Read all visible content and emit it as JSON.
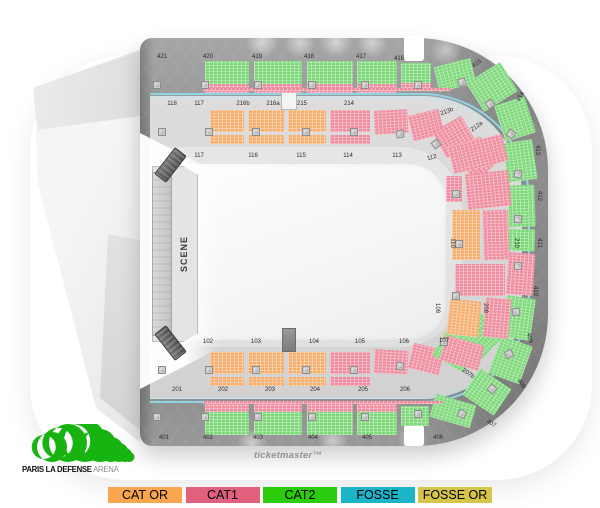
{
  "watermark": {
    "text": "ticketmaster™"
  },
  "logo": {
    "bold": "PARIS LA DEFENSE",
    "light": "ARENA",
    "green": "#17B411"
  },
  "stage": {
    "label": "SCENE"
  },
  "legend": {
    "items": [
      {
        "label": "CAT OR",
        "color": "#FAA64E"
      },
      {
        "label": "CAT1",
        "color": "#E0607D"
      },
      {
        "label": "CAT2",
        "color": "#2BCC0E"
      },
      {
        "label": "FOSSE",
        "color": "#1CB4C8"
      },
      {
        "label": "FOSSE OR",
        "color": "#D6C54B"
      }
    ]
  },
  "map": {
    "seat_colors": {
      "or": "#F5AE6E",
      "c1": "#EE8C9E",
      "c2": "#7CD878"
    },
    "ring_outer_color": "#8fd3e6",
    "ring_inner_color": "#bfe7f1",
    "sections": [
      {
        "x": 205,
        "y": 61,
        "w": 44,
        "h": 23,
        "c": "c2"
      },
      {
        "x": 205,
        "y": 84,
        "w": 44,
        "h": 9,
        "c": "c1"
      },
      {
        "x": 254,
        "y": 61,
        "w": 48,
        "h": 23,
        "c": "c2"
      },
      {
        "x": 254,
        "y": 84,
        "w": 48,
        "h": 9,
        "c": "c1"
      },
      {
        "x": 307,
        "y": 61,
        "w": 46,
        "h": 23,
        "c": "c2"
      },
      {
        "x": 307,
        "y": 84,
        "w": 46,
        "h": 9,
        "c": "c1"
      },
      {
        "x": 357,
        "y": 61,
        "w": 40,
        "h": 23,
        "c": "c2"
      },
      {
        "x": 357,
        "y": 84,
        "w": 40,
        "h": 9,
        "c": "c1"
      },
      {
        "x": 401,
        "y": 63,
        "w": 30,
        "h": 20,
        "c": "c2"
      },
      {
        "x": 401,
        "y": 83,
        "w": 30,
        "h": 8,
        "c": "c1"
      },
      {
        "x": 436,
        "y": 62,
        "w": 38,
        "h": 26,
        "c": "c2",
        "r": -14
      },
      {
        "x": 472,
        "y": 70,
        "w": 40,
        "h": 34,
        "c": "c2",
        "r": -32
      },
      {
        "x": 203,
        "y": 88,
        "w": 248,
        "h": 3,
        "c": "c1"
      },
      {
        "x": 499,
        "y": 100,
        "w": 32,
        "h": 38,
        "c": "c2",
        "r": -18
      },
      {
        "x": 505,
        "y": 141,
        "w": 30,
        "h": 40,
        "c": "c2",
        "r": -8
      },
      {
        "x": 508,
        "y": 185,
        "w": 27,
        "h": 42,
        "c": "c2",
        "r": -2
      },
      {
        "x": 508,
        "y": 229,
        "w": 27,
        "h": 22,
        "c": "c2",
        "r": 2
      },
      {
        "x": 507,
        "y": 253,
        "w": 27,
        "h": 42,
        "c": "c1",
        "r": 4
      },
      {
        "x": 504,
        "y": 297,
        "w": 29,
        "h": 42,
        "c": "c2",
        "r": 8
      },
      {
        "x": 494,
        "y": 340,
        "w": 33,
        "h": 40,
        "c": "c2",
        "r": 20
      },
      {
        "x": 468,
        "y": 376,
        "w": 38,
        "h": 32,
        "c": "c2",
        "r": 34
      },
      {
        "x": 432,
        "y": 399,
        "w": 42,
        "h": 24,
        "c": "c2",
        "r": 16
      },
      {
        "x": 205,
        "y": 404,
        "w": 44,
        "h": 8,
        "c": "c1"
      },
      {
        "x": 205,
        "y": 412,
        "w": 44,
        "h": 23,
        "c": "c2"
      },
      {
        "x": 254,
        "y": 404,
        "w": 48,
        "h": 8,
        "c": "c1"
      },
      {
        "x": 254,
        "y": 412,
        "w": 48,
        "h": 23,
        "c": "c2"
      },
      {
        "x": 307,
        "y": 404,
        "w": 46,
        "h": 8,
        "c": "c1"
      },
      {
        "x": 307,
        "y": 412,
        "w": 46,
        "h": 23,
        "c": "c2"
      },
      {
        "x": 357,
        "y": 404,
        "w": 40,
        "h": 8,
        "c": "c1"
      },
      {
        "x": 357,
        "y": 412,
        "w": 40,
        "h": 23,
        "c": "c2"
      },
      {
        "x": 401,
        "y": 406,
        "w": 28,
        "h": 20,
        "c": "c2"
      },
      {
        "x": 203,
        "y": 401,
        "w": 240,
        "h": 3,
        "c": "c1"
      },
      {
        "x": 210,
        "y": 110,
        "w": 34,
        "h": 22,
        "c": "or"
      },
      {
        "x": 210,
        "y": 135,
        "w": 34,
        "h": 9,
        "c": "or"
      },
      {
        "x": 248,
        "y": 110,
        "w": 36,
        "h": 22,
        "c": "or"
      },
      {
        "x": 248,
        "y": 135,
        "w": 36,
        "h": 9,
        "c": "or"
      },
      {
        "x": 288,
        "y": 110,
        "w": 38,
        "h": 22,
        "c": "or"
      },
      {
        "x": 288,
        "y": 135,
        "w": 38,
        "h": 9,
        "c": "or"
      },
      {
        "x": 330,
        "y": 110,
        "w": 40,
        "h": 22,
        "c": "c1"
      },
      {
        "x": 330,
        "y": 135,
        "w": 40,
        "h": 9,
        "c": "c1"
      },
      {
        "x": 374,
        "y": 110,
        "w": 34,
        "h": 24,
        "c": "c1",
        "r": -3
      },
      {
        "x": 410,
        "y": 112,
        "w": 32,
        "h": 26,
        "c": "c1",
        "r": -14
      },
      {
        "x": 437,
        "y": 122,
        "w": 34,
        "h": 30,
        "c": "c1",
        "r": -30
      },
      {
        "x": 461,
        "y": 143,
        "w": 34,
        "h": 32,
        "c": "c1",
        "r": -44
      },
      {
        "x": 210,
        "y": 352,
        "w": 34,
        "h": 22,
        "c": "or"
      },
      {
        "x": 210,
        "y": 377,
        "w": 34,
        "h": 9,
        "c": "or"
      },
      {
        "x": 248,
        "y": 352,
        "w": 36,
        "h": 22,
        "c": "or"
      },
      {
        "x": 248,
        "y": 377,
        "w": 36,
        "h": 9,
        "c": "or"
      },
      {
        "x": 288,
        "y": 352,
        "w": 38,
        "h": 22,
        "c": "or"
      },
      {
        "x": 288,
        "y": 377,
        "w": 38,
        "h": 9,
        "c": "or"
      },
      {
        "x": 330,
        "y": 352,
        "w": 40,
        "h": 22,
        "c": "c1"
      },
      {
        "x": 330,
        "y": 377,
        "w": 40,
        "h": 9,
        "c": "c1"
      },
      {
        "x": 374,
        "y": 350,
        "w": 34,
        "h": 24,
        "c": "c1",
        "r": 3
      },
      {
        "x": 410,
        "y": 346,
        "w": 32,
        "h": 26,
        "c": "c1",
        "r": 14
      },
      {
        "x": 437,
        "y": 336,
        "w": 36,
        "h": 30,
        "c": "c2",
        "r": 30
      },
      {
        "x": 462,
        "y": 318,
        "w": 36,
        "h": 34,
        "c": "c2",
        "r": 44
      },
      {
        "x": 450,
        "y": 140,
        "w": 56,
        "h": 28,
        "c": "c1",
        "r": -14
      },
      {
        "x": 466,
        "y": 172,
        "w": 44,
        "h": 36,
        "c": "c1",
        "r": -6
      },
      {
        "x": 446,
        "y": 176,
        "w": 16,
        "h": 26,
        "c": "c1"
      },
      {
        "x": 452,
        "y": 210,
        "w": 28,
        "h": 50,
        "c": "or"
      },
      {
        "x": 483,
        "y": 210,
        "w": 26,
        "h": 50,
        "c": "c1",
        "r": -2
      },
      {
        "x": 455,
        "y": 264,
        "w": 50,
        "h": 32,
        "c": "c1"
      },
      {
        "x": 484,
        "y": 298,
        "w": 26,
        "h": 40,
        "c": "c1",
        "r": 5
      },
      {
        "x": 448,
        "y": 300,
        "w": 32,
        "h": 36,
        "c": "or",
        "r": 6
      },
      {
        "x": 442,
        "y": 340,
        "w": 40,
        "h": 26,
        "c": "c1",
        "r": 16
      }
    ],
    "posts": [
      {
        "x": 153,
        "y": 81
      },
      {
        "x": 201,
        "y": 81
      },
      {
        "x": 254,
        "y": 81
      },
      {
        "x": 308,
        "y": 81
      },
      {
        "x": 361,
        "y": 81
      },
      {
        "x": 414,
        "y": 81
      },
      {
        "x": 458,
        "y": 78,
        "r": -20
      },
      {
        "x": 158,
        "y": 128
      },
      {
        "x": 205,
        "y": 128
      },
      {
        "x": 252,
        "y": 128
      },
      {
        "x": 302,
        "y": 128
      },
      {
        "x": 350,
        "y": 128
      },
      {
        "x": 396,
        "y": 130,
        "r": -10
      },
      {
        "x": 432,
        "y": 140,
        "r": -35
      },
      {
        "x": 486,
        "y": 100,
        "r": -35
      },
      {
        "x": 507,
        "y": 130,
        "r": -55
      },
      {
        "x": 514,
        "y": 170,
        "r": -80
      },
      {
        "x": 514,
        "y": 215,
        "r": -85
      },
      {
        "x": 514,
        "y": 262,
        "r": -88
      },
      {
        "x": 512,
        "y": 308,
        "r": 80
      },
      {
        "x": 505,
        "y": 350,
        "r": 65
      },
      {
        "x": 488,
        "y": 385,
        "r": 40
      },
      {
        "x": 458,
        "y": 410,
        "r": 25
      },
      {
        "x": 452,
        "y": 190
      },
      {
        "x": 455,
        "y": 240
      },
      {
        "x": 452,
        "y": 292
      },
      {
        "x": 440,
        "y": 338
      },
      {
        "x": 158,
        "y": 366
      },
      {
        "x": 205,
        "y": 366
      },
      {
        "x": 252,
        "y": 366
      },
      {
        "x": 302,
        "y": 366
      },
      {
        "x": 350,
        "y": 366
      },
      {
        "x": 396,
        "y": 362,
        "r": 10
      },
      {
        "x": 153,
        "y": 413
      },
      {
        "x": 201,
        "y": 413
      },
      {
        "x": 254,
        "y": 413
      },
      {
        "x": 308,
        "y": 413
      },
      {
        "x": 361,
        "y": 413
      },
      {
        "x": 414,
        "y": 410
      }
    ],
    "labels": [
      {
        "t": "421",
        "x": 162,
        "y": 57
      },
      {
        "t": "420",
        "x": 208,
        "y": 57
      },
      {
        "t": "419",
        "x": 257,
        "y": 57
      },
      {
        "t": "418",
        "x": 309,
        "y": 57
      },
      {
        "t": "417",
        "x": 361,
        "y": 57
      },
      {
        "t": "416",
        "x": 399,
        "y": 59
      },
      {
        "t": "415",
        "x": 477,
        "y": 64,
        "r": -35
      },
      {
        "t": "414",
        "x": 521,
        "y": 97,
        "r": -60
      },
      {
        "t": "413",
        "x": 537,
        "y": 150,
        "r": 90
      },
      {
        "t": "412",
        "x": 539,
        "y": 196,
        "r": 90
      },
      {
        "t": "411",
        "x": 539,
        "y": 243,
        "r": 90
      },
      {
        "t": "410",
        "x": 535,
        "y": 291,
        "r": 90
      },
      {
        "t": "409",
        "x": 529,
        "y": 338,
        "r": 78
      },
      {
        "t": "408",
        "x": 521,
        "y": 384,
        "r": 55
      },
      {
        "t": "407",
        "x": 491,
        "y": 424,
        "r": 30
      },
      {
        "t": "406",
        "x": 438,
        "y": 438
      },
      {
        "t": "405",
        "x": 367,
        "y": 438
      },
      {
        "t": "404",
        "x": 313,
        "y": 438
      },
      {
        "t": "403",
        "x": 258,
        "y": 438
      },
      {
        "t": "402",
        "x": 208,
        "y": 438
      },
      {
        "t": "401",
        "x": 164,
        "y": 438
      },
      {
        "t": "118",
        "x": 172,
        "y": 104
      },
      {
        "t": "117",
        "x": 199,
        "y": 104
      },
      {
        "t": "216b",
        "x": 243,
        "y": 104
      },
      {
        "t": "216a",
        "x": 273,
        "y": 104
      },
      {
        "t": "215",
        "x": 302,
        "y": 104
      },
      {
        "t": "214",
        "x": 349,
        "y": 104
      },
      {
        "t": "213b",
        "x": 447,
        "y": 112,
        "r": -20
      },
      {
        "t": "212a",
        "x": 477,
        "y": 127,
        "r": -35
      },
      {
        "t": "117",
        "x": 199,
        "y": 156
      },
      {
        "t": "116",
        "x": 253,
        "y": 156
      },
      {
        "t": "115",
        "x": 301,
        "y": 156
      },
      {
        "t": "114",
        "x": 348,
        "y": 156
      },
      {
        "t": "113",
        "x": 397,
        "y": 156
      },
      {
        "t": "112",
        "x": 432,
        "y": 158,
        "r": -15
      },
      {
        "t": "110",
        "x": 452,
        "y": 243,
        "r": 90
      },
      {
        "t": "210",
        "x": 516,
        "y": 243,
        "r": 90
      },
      {
        "t": "108",
        "x": 437,
        "y": 308,
        "r": 90
      },
      {
        "t": "208",
        "x": 485,
        "y": 308,
        "r": 90
      },
      {
        "t": "102",
        "x": 208,
        "y": 342
      },
      {
        "t": "103",
        "x": 256,
        "y": 342
      },
      {
        "t": "104",
        "x": 314,
        "y": 342
      },
      {
        "t": "105",
        "x": 360,
        "y": 342
      },
      {
        "t": "106",
        "x": 404,
        "y": 342
      },
      {
        "t": "107",
        "x": 444,
        "y": 341
      },
      {
        "t": "201",
        "x": 177,
        "y": 390
      },
      {
        "t": "202",
        "x": 223,
        "y": 390
      },
      {
        "t": "203",
        "x": 270,
        "y": 390
      },
      {
        "t": "204",
        "x": 315,
        "y": 390
      },
      {
        "t": "205",
        "x": 363,
        "y": 390
      },
      {
        "t": "206",
        "x": 405,
        "y": 390
      },
      {
        "t": "207b",
        "x": 468,
        "y": 374,
        "r": 35
      }
    ]
  }
}
